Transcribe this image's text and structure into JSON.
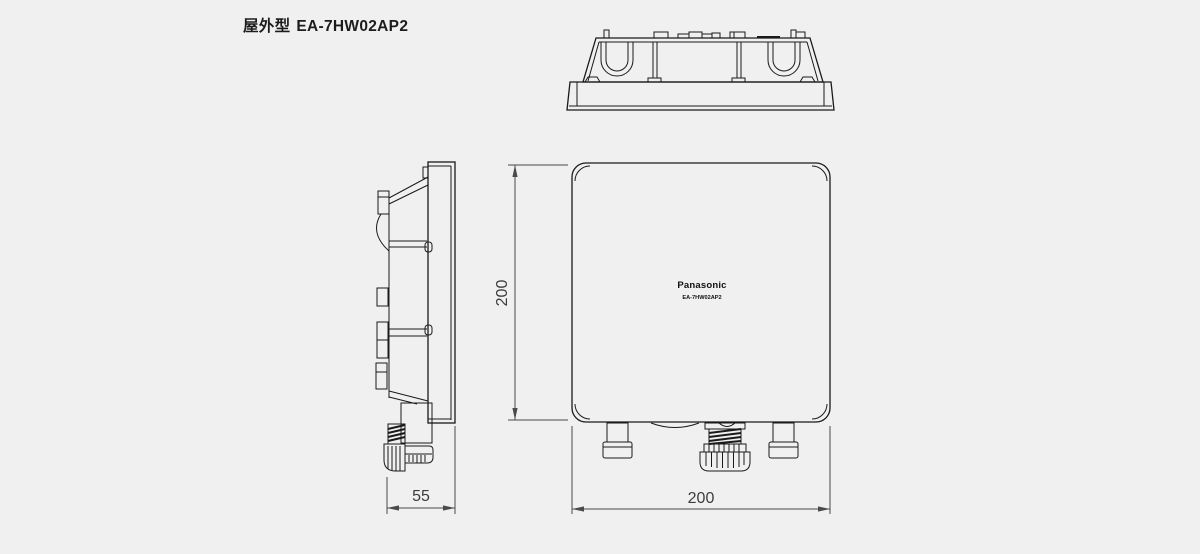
{
  "colors": {
    "background": "#f0f0f0",
    "line": "#1a1a1a",
    "dim_text": "#3c3c3c"
  },
  "title": {
    "prefix": "屋外型",
    "model": "EA-7HW02AP2"
  },
  "front_view": {
    "logo": "Panasonic",
    "model": "EA-7HW02AP2",
    "height_mm": "200",
    "width_mm": "200"
  },
  "side_view": {
    "depth_mm": "55"
  }
}
